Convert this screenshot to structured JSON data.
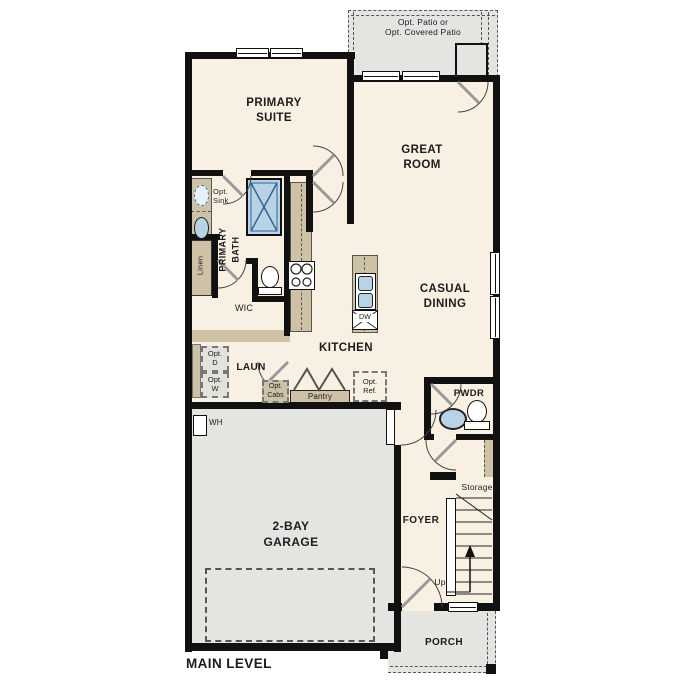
{
  "plan": {
    "title": "MAIN LEVEL",
    "patio": {
      "l1": "Opt. Patio or",
      "l2": "Opt. Covered Patio"
    },
    "primary_suite": {
      "l1": "PRIMARY",
      "l2": "SUITE"
    },
    "great_room": {
      "l1": "GREAT",
      "l2": "ROOM"
    },
    "casual_dining": {
      "l1": "CASUAL",
      "l2": "DINING"
    },
    "kitchen": "KITCHEN",
    "primary_bath": {
      "l1": "PRIMARY",
      "l2": "BATH"
    },
    "opt_sink": {
      "l1": "Opt.",
      "l2": "Sink"
    },
    "linen": "Linen",
    "wic": "WIC",
    "laundry": "LAUN",
    "opt_dryer": {
      "l1": "Opt.",
      "l2": "D"
    },
    "opt_washer": {
      "l1": "Opt.",
      "l2": "W"
    },
    "opt_cabs": {
      "l1": "Opt.",
      "l2": "Cabs"
    },
    "pantry": "Pantry",
    "opt_ref": {
      "l1": "Opt.",
      "l2": "Ref."
    },
    "dishwasher": "DW",
    "powder": "PWDR",
    "storage": "Storage",
    "foyer": "FOYER",
    "stairs_up": "Up",
    "garage": {
      "l1": "2-BAY",
      "l2": "GARAGE"
    },
    "water_heater": "WH",
    "porch": "PORCH"
  },
  "colors": {
    "wall": "#111111",
    "interior_floor": "#f8f1e3",
    "exterior_floor": "#e4e4e1",
    "cabinetry": "#cdc1a6",
    "fixture_blue": "#b8d3e8",
    "text": "#1c1c1c"
  }
}
